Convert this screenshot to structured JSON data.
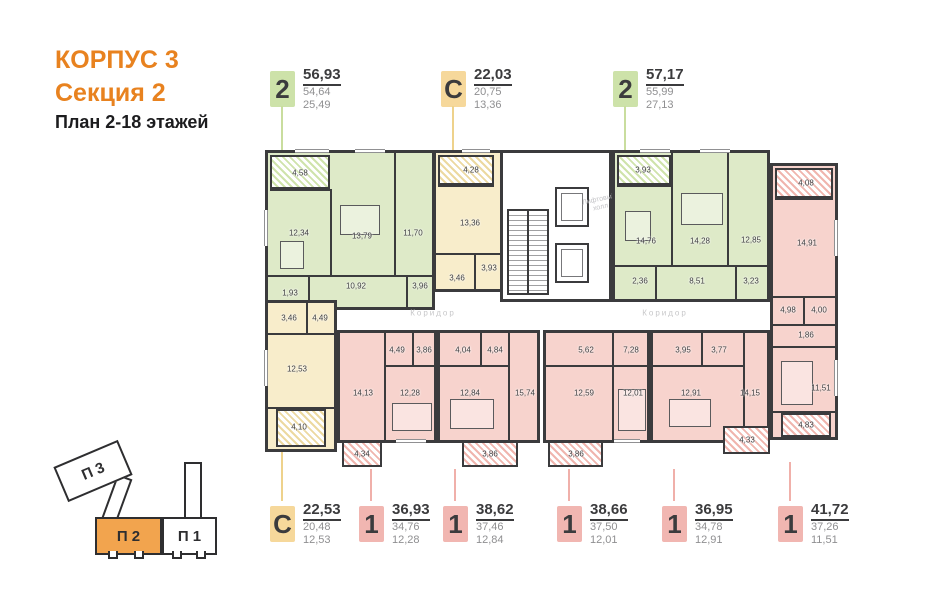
{
  "title": {
    "line1": "КОРПУС 3",
    "line2": "Секция 2",
    "line3": "План 2-18 этажей"
  },
  "colors": {
    "accent_orange": "#e8821f",
    "green": "#cde2a9",
    "yellow": "#f6d89b",
    "pink": "#f1b6b1",
    "wall": "#3b3b3d"
  },
  "legend_top": [
    {
      "mark": "2",
      "values": [
        "56,93",
        "54,64",
        "25,49"
      ]
    },
    {
      "mark": "С",
      "values": [
        "22,03",
        "20,75",
        "13,36"
      ]
    },
    {
      "mark": "2",
      "values": [
        "57,17",
        "55,99",
        "27,13"
      ]
    }
  ],
  "legend_bottom": [
    {
      "mark": "С",
      "values": [
        "22,53",
        "20,48",
        "12,53"
      ]
    },
    {
      "mark": "1",
      "values": [
        "36,93",
        "34,76",
        "12,28"
      ]
    },
    {
      "mark": "1",
      "values": [
        "38,62",
        "37,46",
        "12,84"
      ]
    },
    {
      "mark": "1",
      "values": [
        "38,66",
        "37,50",
        "12,01"
      ]
    },
    {
      "mark": "1",
      "values": [
        "36,95",
        "34,78",
        "12,91"
      ]
    },
    {
      "mark": "1",
      "values": [
        "41,72",
        "37,26",
        "11,51"
      ]
    }
  ],
  "minimap": {
    "p3": "П 3",
    "p2": "П 2",
    "p1": "П 1"
  },
  "plan": {
    "corridor": "Коридор",
    "lift1": "Лифтовый",
    "lift2": "холл",
    "apartments": {
      "top_left": {
        "balcony": "4,58",
        "kitchen": "12,34",
        "bedroom": "13,79",
        "room": "11,70",
        "hall": "10,92",
        "wc": "1,93",
        "bath": "3,96"
      },
      "top_studio": {
        "balcony": "4,28",
        "room": "13,36",
        "hall": "3,93",
        "bath": "3,46"
      },
      "top_right": {
        "balcony": "3,93",
        "room1": "14,76",
        "room2": "14,28",
        "room3": "12,85",
        "wc": "2,36",
        "hall": "8,51",
        "bath": "3,23"
      },
      "right": {
        "balcony_top": "4,08",
        "kitchen": "14,91",
        "hall": "4,98",
        "bath": "4,00",
        "wc": "1,86",
        "bedroom": "11,51",
        "balcony_bottom": "4,83"
      },
      "bot_studio": {
        "bath": "3,46",
        "hall": "4,49",
        "room": "12,53",
        "balcony": "4,10"
      },
      "b1": {
        "living": "14,13",
        "hall": "4,49",
        "bath": "3,86",
        "bedroom": "12,28",
        "balcony": "4,34"
      },
      "b2": {
        "bath": "4,04",
        "hall": "4,84",
        "bedroom": "12,84",
        "living": "15,74",
        "balcony": "3,86"
      },
      "b3": {
        "bath": "5,62",
        "hall": "7,28",
        "kitchen": "12,59",
        "bedroom": "12,01",
        "balcony": "3,86"
      },
      "b4": {
        "bath": "3,95",
        "hall": "3,77",
        "bedroom": "12,91",
        "living": "14,15",
        "balcony": "4,33"
      }
    }
  }
}
